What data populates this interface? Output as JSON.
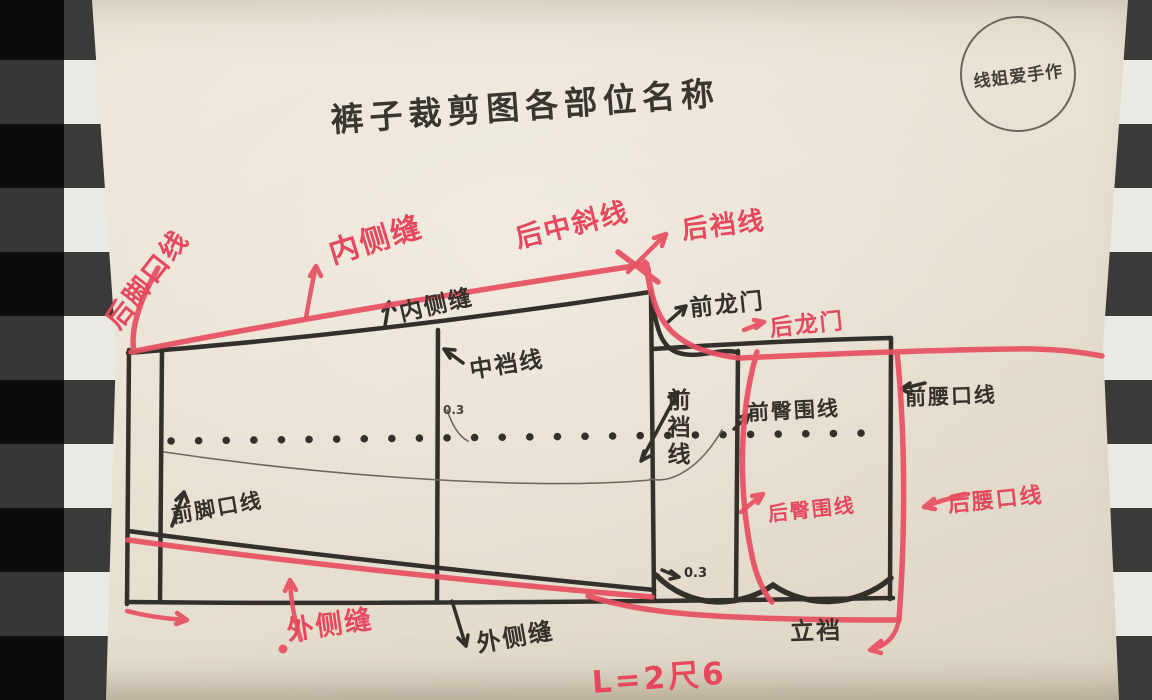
{
  "title": "裤子裁剪图各部位名称",
  "stamp": "线姐爱手作",
  "diagram": {
    "labels": {
      "back_hem_line": "后脚口线",
      "inner_seam_red": "内侧缝",
      "inner_seam_black": "内侧缝",
      "back_center_slant_line": "后中斜线",
      "back_crotch_line": "后裆线",
      "front_crotch_gate": "前龙门",
      "back_crotch_gate": "后龙门",
      "mid_crotch_line": "中裆线",
      "front_crotch_line": "前裆线",
      "front_hip_line": "前臀围线",
      "front_waist_line": "前腰口线",
      "back_hip_line": "后臀围线",
      "back_waist_line": "后腰口线",
      "front_hem_line": "前脚口线",
      "outer_seam_red": "外侧缝",
      "outer_seam_black": "外侧缝",
      "rise": "立裆",
      "note_mid": "0.3",
      "note_crotch": "0.3",
      "formula": "L=2尺6"
    },
    "colors": {
      "marker_red": "#e6495e",
      "marker_black": "#35312a",
      "paper": "#e9e1d2"
    }
  }
}
